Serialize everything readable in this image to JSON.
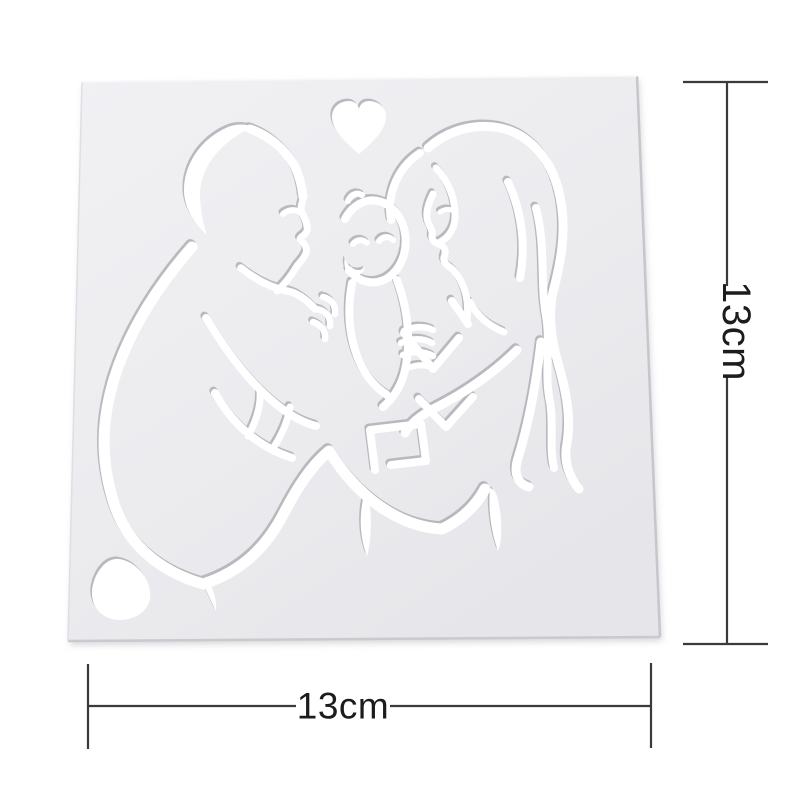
{
  "page": {
    "background_color": "#ffffff"
  },
  "product": {
    "name": "family-heart-stencil",
    "description": "Square plastic craft stencil with cut-out line art of a father kissing a baby held between him and the mother, a small heart cut out above them and a heart-shaped hole in the bottom-left corner",
    "plate_color": "#ececef",
    "cutout_color": "#ffffff",
    "cutout_shadow_color": "#a3a3ab",
    "plate_edge_color": "#c6c6cc"
  },
  "dimensions": {
    "height_label": "13cm",
    "width_label": "13cm",
    "line_color": "#3a3a3c",
    "label_color": "#1c1c1e"
  }
}
